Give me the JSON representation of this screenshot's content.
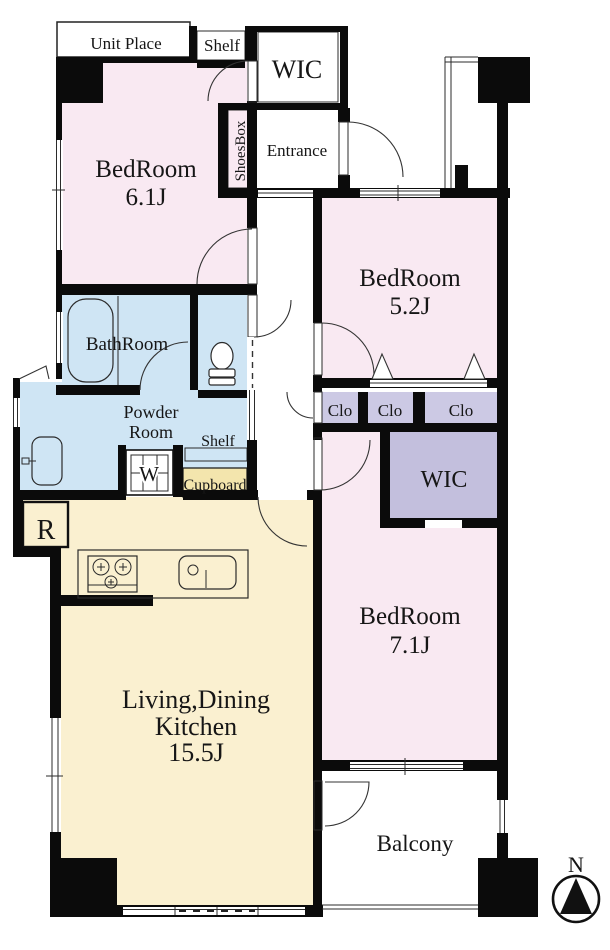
{
  "plan": {
    "unit_place": "Unit Place",
    "shelf_top": "Shelf",
    "wic_top": "WIC",
    "shoes_box": "ShoesBox",
    "entrance": "Entrance",
    "bedroom_a": {
      "name": "BedRoom",
      "size": "6.1J"
    },
    "bedroom_b": {
      "name": "BedRoom",
      "size": "5.2J"
    },
    "bedroom_c": {
      "name": "BedRoom",
      "size": "7.1J"
    },
    "bathroom": "BathRoom",
    "powder_room": {
      "line1": "Powder",
      "line2": "Room"
    },
    "shelf_powder": "Shelf",
    "washing_machine": "W",
    "cupboard": "Cupboard",
    "closets": [
      "Clo",
      "Clo",
      "Clo"
    ],
    "wic_lower": "WIC",
    "refrigerator": "R",
    "ldk": {
      "line1": "Living,Dining",
      "line2": "Kitchen",
      "size": "15.5J"
    },
    "balcony": "Balcony",
    "compass_north": "N"
  },
  "colors": {
    "wall": "#0b0b0b",
    "bedroom_pink": "#f9e9f2",
    "wet_area_blue": "#cfe5f4",
    "closet_lavender": "#ccc9e4",
    "wic_lavender": "#c3bfdd",
    "shoesbox_lavender": "#b3b0d2",
    "ldk_cream": "#faf0d0",
    "cupboard_yellow": "#f3e5ad"
  }
}
